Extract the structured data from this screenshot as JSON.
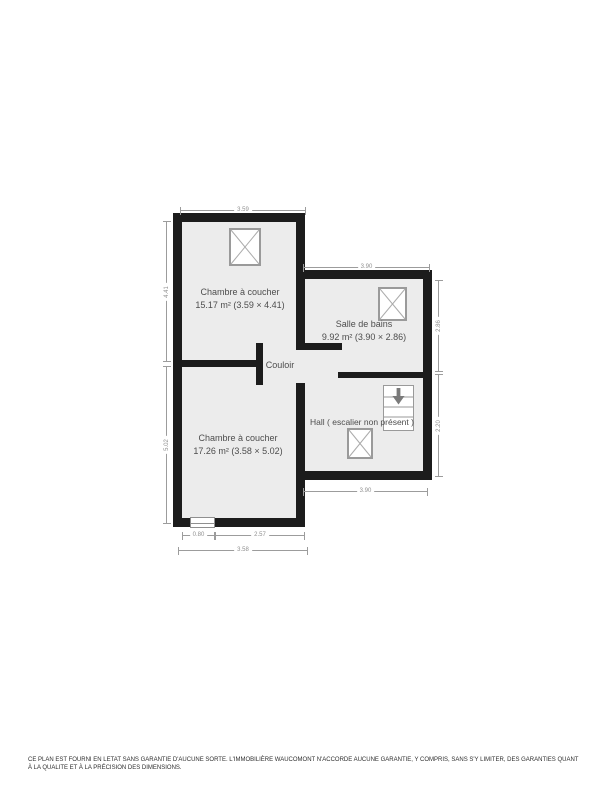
{
  "colors": {
    "wall": "#1c1c1c",
    "floor": "#ececec",
    "dim": "#9c9c9c",
    "label": "#4d4d4d",
    "symbol-stroke": "#8f8f8f"
  },
  "rooms": {
    "chambre1": {
      "name": "Chambre à coucher",
      "area": "15.17 m² (3.59 × 4.41)"
    },
    "salle_de_bains": {
      "name": "Salle de bains",
      "area": "9.92 m² (3.90 × 2.86)"
    },
    "couloir": {
      "name": "Couloir"
    },
    "hall": {
      "name": "Hall ( escalier non présent )"
    },
    "chambre2": {
      "name": "Chambre à coucher",
      "area": "17.26 m² (3.58 × 5.02)"
    }
  },
  "dimensions": {
    "chambre1_width": "3.59",
    "chambre1_depth": "4.41",
    "chambre2_depth": "5.02",
    "salle_de_bains_width": "3.90",
    "salle_de_bains_depth": "2.86",
    "hall_depth": "2.20",
    "hall_width": "3.90",
    "window_offset": "0.80",
    "wall_segment": "2.57",
    "chambre2_width": "3.58"
  },
  "footer": {
    "disclaimer": "CE PLAN EST FOURNI EN LETAT SANS GARANTIE D'AUCUNE SORTE. L'IMMOBILIÈRE WAUCOMONT N'ACCORDE AUCUNE GARANTIE, Y COMPRIS, SANS S'Y LIMITER, DES GARANTIES QUANT À LA QUALITE ET À LA PRÉCISION DES DIMENSIONS."
  }
}
